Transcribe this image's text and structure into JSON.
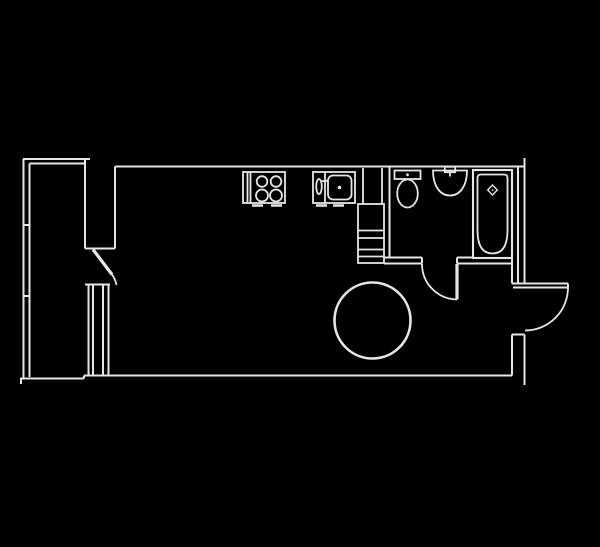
{
  "plan": {
    "unit_label": "116",
    "colors": {
      "background": "#000000",
      "line": "#e6e6e6",
      "label": "#efefef"
    },
    "fixtures": [
      "loggia-glazing",
      "balcony-door",
      "window",
      "stove",
      "kitchen-sink",
      "ventilation-shaft",
      "toilet",
      "washbasin",
      "bathtub",
      "bathroom-door",
      "entrance-door",
      "unit-number-badge"
    ]
  }
}
